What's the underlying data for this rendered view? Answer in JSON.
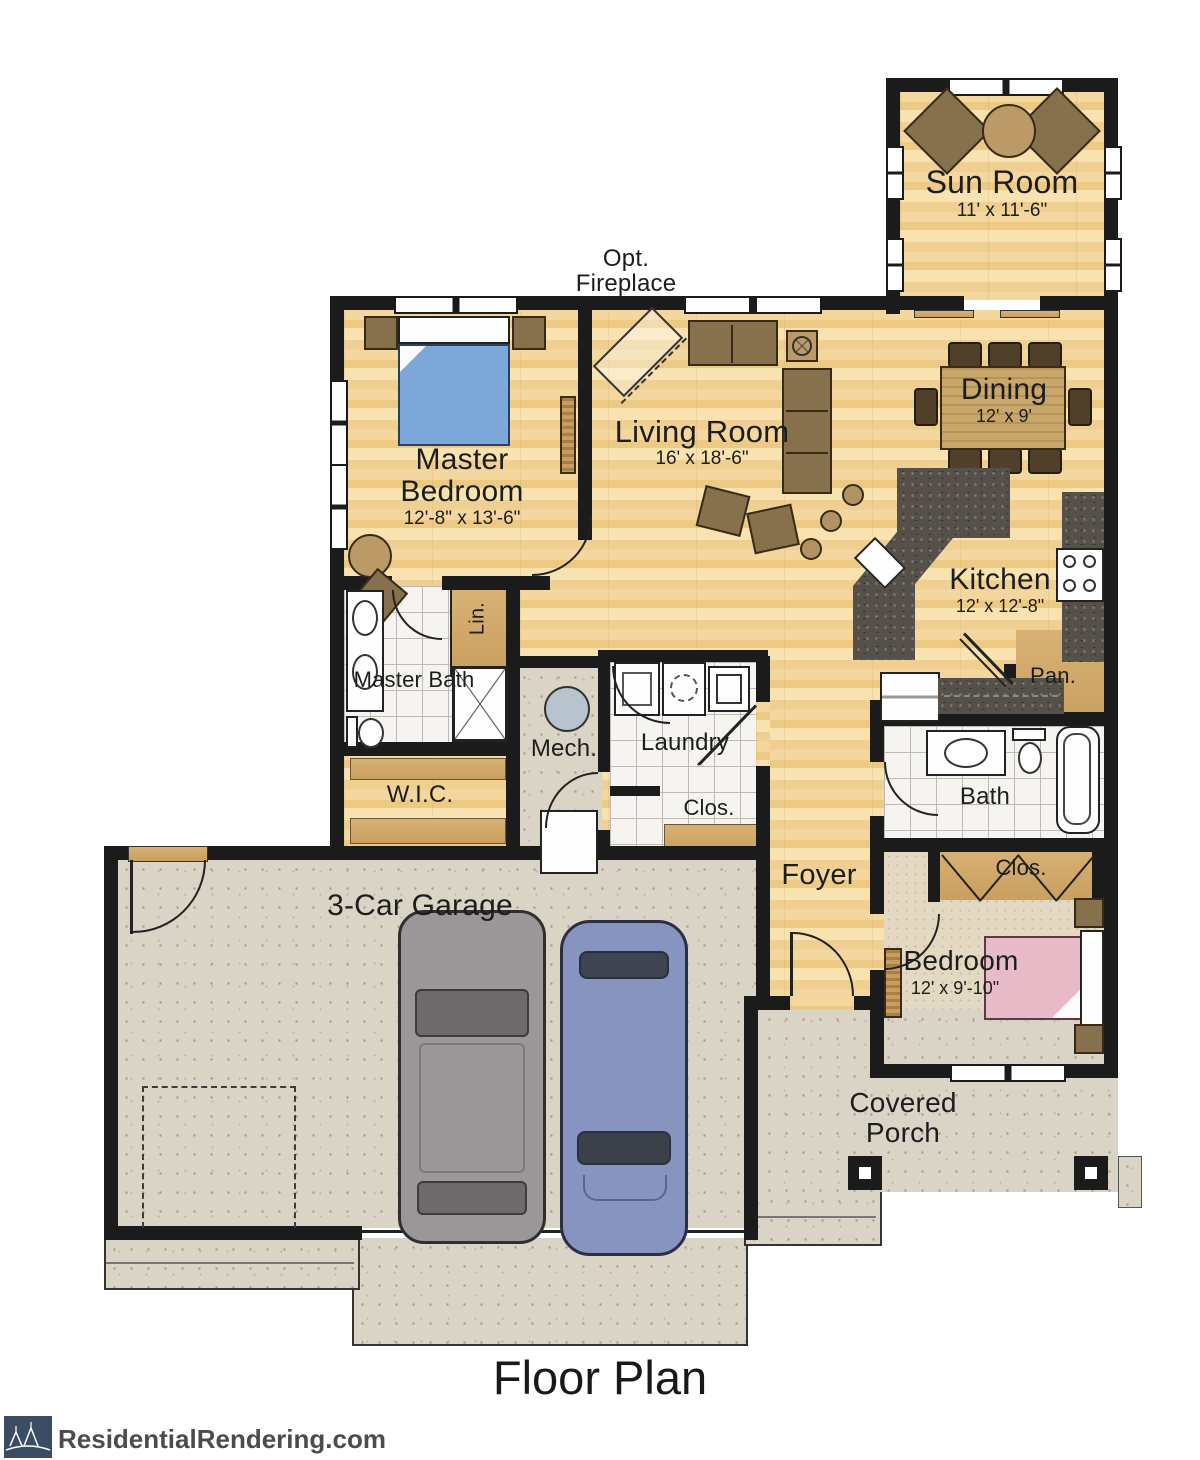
{
  "title": "Floor Plan",
  "branding": {
    "site": "ResidentialRendering.com"
  },
  "annotations": {
    "optional_fireplace": "Opt. Fireplace"
  },
  "rooms": [
    {
      "id": "sun-room",
      "name": "Sun Room",
      "dims": "11' x 11'-6\""
    },
    {
      "id": "living-room",
      "name": "Living Room",
      "dims": "16' x 18'-6\""
    },
    {
      "id": "dining",
      "name": "Dining",
      "dims": "12' x 9'"
    },
    {
      "id": "kitchen",
      "name": "Kitchen",
      "dims": "12' x 12'-8\""
    },
    {
      "id": "master-bedroom",
      "name": "Master Bedroom",
      "dims": "12'-8\" x 13'-6\""
    },
    {
      "id": "master-bath",
      "name": "Master Bath"
    },
    {
      "id": "linen",
      "name": "Lin."
    },
    {
      "id": "walk-in-closet",
      "name": "W.I.C."
    },
    {
      "id": "mechanical",
      "name": "Mech."
    },
    {
      "id": "laundry",
      "name": "Laundry"
    },
    {
      "id": "hall-closet",
      "name": "Clos."
    },
    {
      "id": "pantry",
      "name": "Pan."
    },
    {
      "id": "bath",
      "name": "Bath"
    },
    {
      "id": "foyer",
      "name": "Foyer"
    },
    {
      "id": "bedroom-closet",
      "name": "Clos."
    },
    {
      "id": "bedroom",
      "name": "Bedroom",
      "dims": "12' x 9'-10\""
    },
    {
      "id": "garage",
      "name": "3-Car Garage"
    },
    {
      "id": "covered-porch",
      "name": "Covered Porch"
    }
  ],
  "palette": {
    "wall": "#1b1b1b",
    "wood_floor": "#f1d49b",
    "closet_tan": "#d4ad6e",
    "tile": "#f5f4f1",
    "concrete": "#dad4c7",
    "carpet": "#e3d9c3",
    "granite": "#55504a",
    "bed_blue": "#7ba8d8",
    "bed_pink": "#e7bcc8",
    "car_gray": "#9b9697",
    "car_blue": "#8794c0",
    "logo_navy": "#3a4d63"
  }
}
